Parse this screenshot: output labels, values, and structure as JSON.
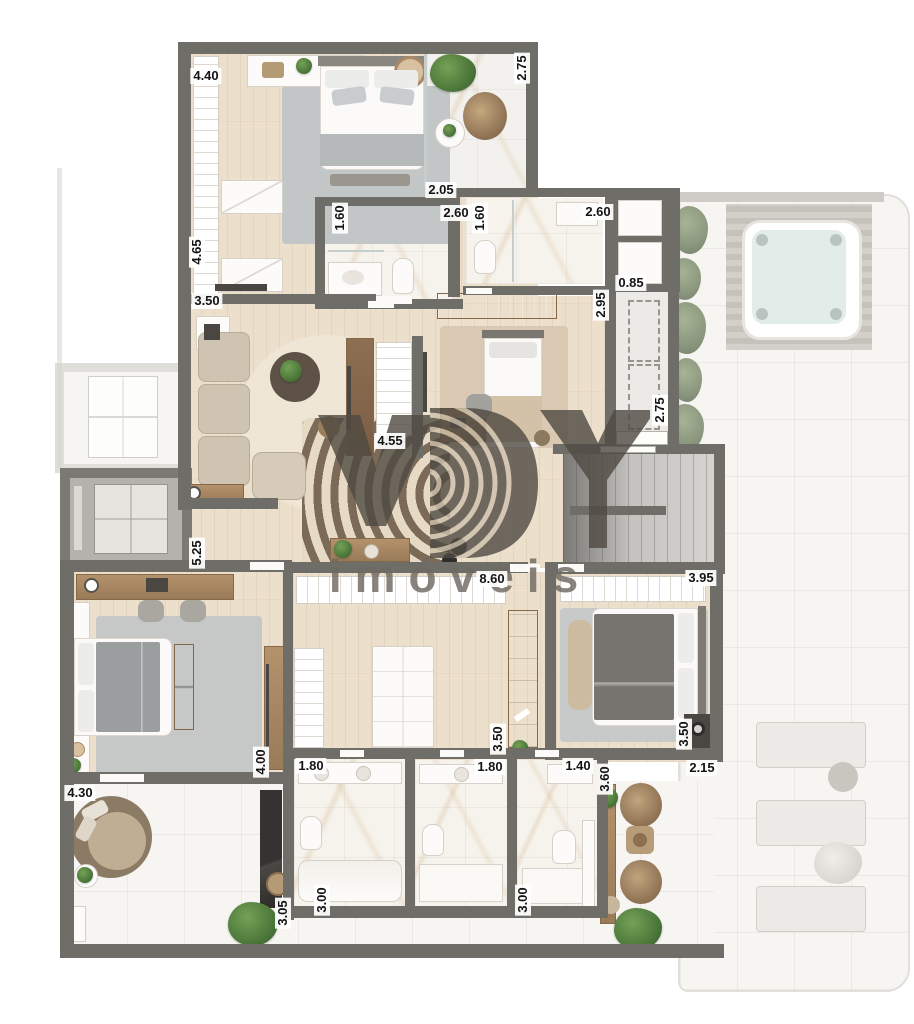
{
  "brand": {
    "logo_letters": "VBY",
    "wordmark": "imóveis"
  },
  "plan": {
    "type": "residential-floor-plan",
    "dimension_unit": "m"
  },
  "colors": {
    "wall": "#6f6d67",
    "wood_floor": "#ecdfcc",
    "marble_floor": "#f6f2ec",
    "terrace_floor": "#f7f5f2",
    "rug_gray": "#c6c8c8",
    "rug_beige": "#d9c9b3",
    "furniture_wood": "#a98a66",
    "plant_green": "#4a7539",
    "watermark": "#4f4a42"
  },
  "dimensions": [
    {
      "label": "4.40",
      "x": 206,
      "y": 76,
      "orient": "h"
    },
    {
      "label": "2.75",
      "x": 522,
      "y": 68,
      "orient": "v"
    },
    {
      "label": "4.65",
      "x": 197,
      "y": 252,
      "orient": "v"
    },
    {
      "label": "3.50",
      "x": 207,
      "y": 301,
      "orient": "h"
    },
    {
      "label": "2.05",
      "x": 441,
      "y": 190,
      "orient": "h"
    },
    {
      "label": "1.60",
      "x": 340,
      "y": 218,
      "orient": "v"
    },
    {
      "label": "2.60",
      "x": 456,
      "y": 213,
      "orient": "h"
    },
    {
      "label": "1.60",
      "x": 480,
      "y": 218,
      "orient": "v"
    },
    {
      "label": "2.60",
      "x": 598,
      "y": 212,
      "orient": "h"
    },
    {
      "label": "0.85",
      "x": 631,
      "y": 283,
      "orient": "h"
    },
    {
      "label": "2.95",
      "x": 601,
      "y": 305,
      "orient": "v"
    },
    {
      "label": "2.75",
      "x": 660,
      "y": 410,
      "orient": "v"
    },
    {
      "label": "4.55",
      "x": 390,
      "y": 441,
      "orient": "h"
    },
    {
      "label": "5.25",
      "x": 197,
      "y": 553,
      "orient": "v"
    },
    {
      "label": "8.60",
      "x": 492,
      "y": 579,
      "orient": "h"
    },
    {
      "label": "3.95",
      "x": 701,
      "y": 578,
      "orient": "h"
    },
    {
      "label": "4.00",
      "x": 261,
      "y": 762,
      "orient": "v"
    },
    {
      "label": "3.50",
      "x": 498,
      "y": 739,
      "orient": "v"
    },
    {
      "label": "3.50",
      "x": 684,
      "y": 734,
      "orient": "v"
    },
    {
      "label": "4.30",
      "x": 80,
      "y": 793,
      "orient": "h"
    },
    {
      "label": "1.80",
      "x": 311,
      "y": 766,
      "orient": "h"
    },
    {
      "label": "1.80",
      "x": 490,
      "y": 767,
      "orient": "h"
    },
    {
      "label": "1.40",
      "x": 578,
      "y": 766,
      "orient": "h"
    },
    {
      "label": "3.60",
      "x": 605,
      "y": 779,
      "orient": "v"
    },
    {
      "label": "2.15",
      "x": 702,
      "y": 768,
      "orient": "h"
    },
    {
      "label": "3.00",
      "x": 322,
      "y": 900,
      "orient": "v"
    },
    {
      "label": "3.00",
      "x": 523,
      "y": 900,
      "orient": "v"
    },
    {
      "label": "3.05",
      "x": 283,
      "y": 913,
      "orient": "v"
    }
  ]
}
